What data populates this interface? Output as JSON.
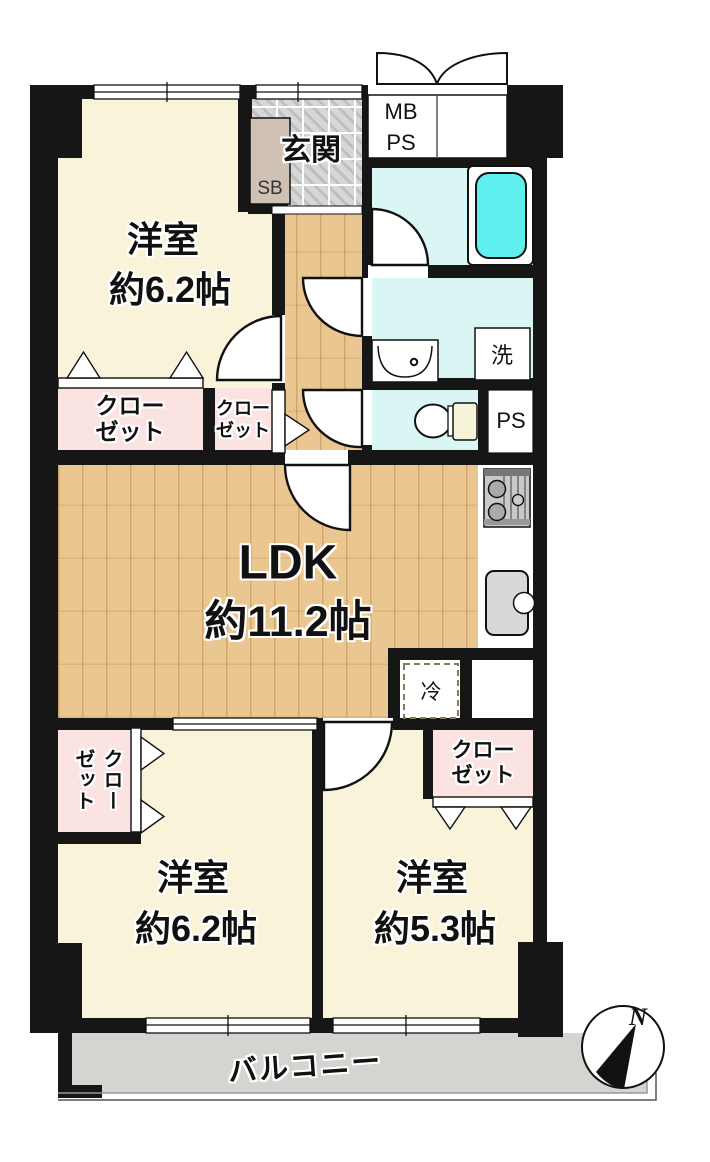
{
  "floorplan": {
    "bedroom_top": {
      "name": "洋室",
      "size": "約6.2帖"
    },
    "bedroom_bottom_left": {
      "name": "洋室",
      "size": "約6.2帖"
    },
    "bedroom_bottom_right": {
      "name": "洋室",
      "size": "約5.3帖"
    },
    "ldk": {
      "name": "LDK",
      "size": "約11.2帖"
    },
    "entrance": "玄関",
    "balcony": "バルコニー",
    "shoe_box": "SB",
    "meter_pipe_space": {
      "line1": "MB",
      "line2": "PS"
    },
    "washing_machine": "洗",
    "pipe_space": "PS",
    "refrigerator": "冷",
    "closet": {
      "line1": "クロー",
      "line2": "ゼット"
    },
    "compass_north": "N",
    "colors": {
      "wall": "#161616",
      "room_cream": "#f8f3d9",
      "closet_pink": "#fbe3e1",
      "wet_area_cyan": "#d9f6f5",
      "bathtub_cyan": "#5fefee",
      "flooring_wood": "#eac690",
      "entrance_tile": "#d7d7d7",
      "balcony_gray": "#d4d4d0"
    }
  }
}
